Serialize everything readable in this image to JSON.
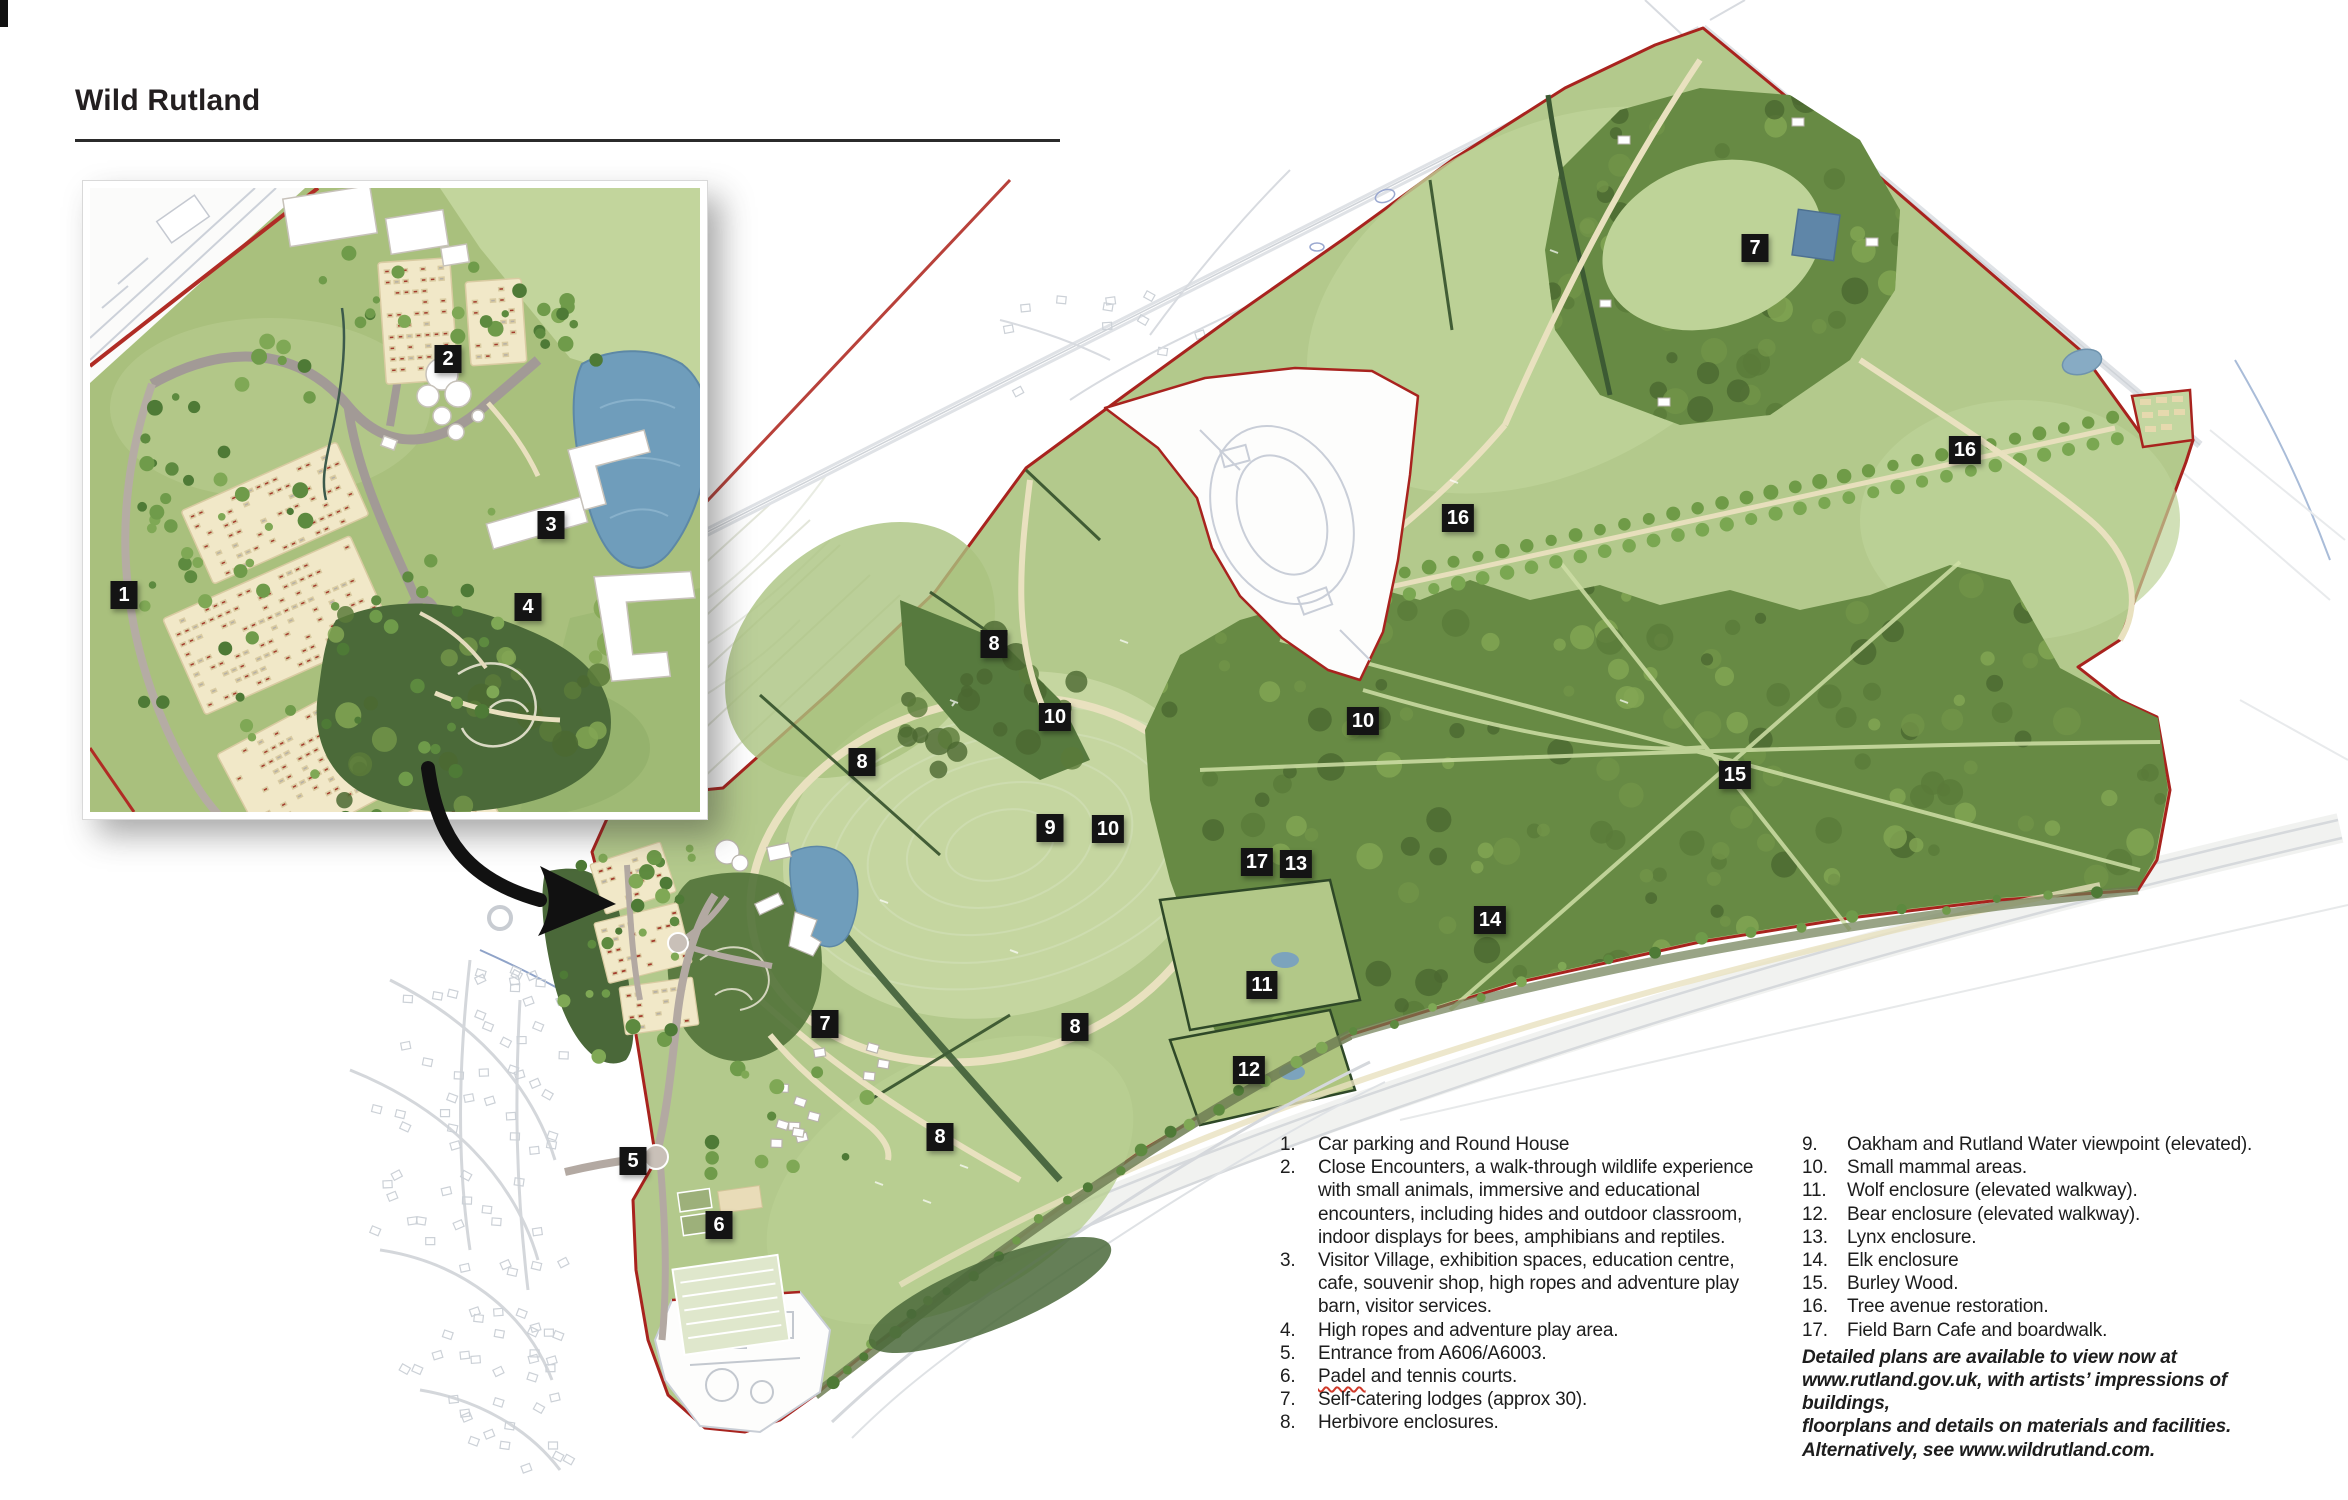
{
  "title": "Wild Rutland",
  "legend": {
    "col1": [
      {
        "n": "1.",
        "text": "Car parking and Round House"
      },
      {
        "n": "2.",
        "text": "Close Encounters, a walk-through wildlife experience with small animals, immersive and educational encounters, including hides and outdoor classroom, indoor displays for bees, amphibians and reptiles."
      },
      {
        "n": "3.",
        "text": "Visitor Village, exhibition spaces, education centre, cafe, souvenir shop, high ropes and adventure play barn, visitor services."
      },
      {
        "n": "4.",
        "text": "High ropes and adventure play area."
      },
      {
        "n": "5.",
        "text": "Entrance from A606/A6003."
      },
      {
        "n": "6.",
        "text": "Padel and tennis courts.",
        "squiggle_word": "Padel"
      },
      {
        "n": "7.",
        "text": "Self-catering lodges (approx 30)."
      },
      {
        "n": "8.",
        "text": "Herbivore enclosures."
      }
    ],
    "col2": [
      {
        "n": "9.",
        "text": "Oakham and Rutland Water viewpoint (elevated)."
      },
      {
        "n": "10.",
        "text": "Small mammal areas."
      },
      {
        "n": "11.",
        "text": "Wolf enclosure (elevated walkway)."
      },
      {
        "n": "12.",
        "text": "Bear enclosure (elevated walkway)."
      },
      {
        "n": "13.",
        "text": "Lynx enclosure."
      },
      {
        "n": "14.",
        "text": "Elk enclosure"
      },
      {
        "n": "15.",
        "text": "Burley Wood."
      },
      {
        "n": "16.",
        "text": "Tree avenue restoration."
      },
      {
        "n": "17.",
        "text": "Field Barn Cafe and boardwalk."
      }
    ],
    "note_lines": [
      "Detailed plans are available to view now at",
      "www.rutland.gov.uk, with artists’ impressions of buildings,",
      "floorplans and details on materials and facilities.",
      "Alternatively, see www.wildrutland.com."
    ]
  },
  "markers": {
    "inset": [
      {
        "n": "1",
        "x": 124,
        "y": 595
      },
      {
        "n": "2",
        "x": 448,
        "y": 359
      },
      {
        "n": "3",
        "x": 551,
        "y": 525
      },
      {
        "n": "4",
        "x": 528,
        "y": 607
      }
    ],
    "main": [
      {
        "n": "7",
        "x": 1755,
        "y": 248
      },
      {
        "n": "16",
        "x": 1965,
        "y": 450
      },
      {
        "n": "16",
        "x": 1458,
        "y": 518
      },
      {
        "n": "8",
        "x": 994,
        "y": 644
      },
      {
        "n": "10",
        "x": 1055,
        "y": 717
      },
      {
        "n": "10",
        "x": 1363,
        "y": 721
      },
      {
        "n": "8",
        "x": 862,
        "y": 762
      },
      {
        "n": "15",
        "x": 1735,
        "y": 775
      },
      {
        "n": "9",
        "x": 1050,
        "y": 828
      },
      {
        "n": "10",
        "x": 1108,
        "y": 829
      },
      {
        "n": "17",
        "x": 1257,
        "y": 862
      },
      {
        "n": "13",
        "x": 1296,
        "y": 864
      },
      {
        "n": "14",
        "x": 1490,
        "y": 920
      },
      {
        "n": "11",
        "x": 1262,
        "y": 985
      },
      {
        "n": "7",
        "x": 825,
        "y": 1024
      },
      {
        "n": "8",
        "x": 1075,
        "y": 1027
      },
      {
        "n": "12",
        "x": 1249,
        "y": 1070
      },
      {
        "n": "8",
        "x": 940,
        "y": 1137
      },
      {
        "n": "5",
        "x": 633,
        "y": 1161
      },
      {
        "n": "6",
        "x": 719,
        "y": 1225
      }
    ]
  },
  "colors": {
    "boundary_red": "#a8231e",
    "field_green": "#b3c98c",
    "woodland_green": "#678a44",
    "dark_wood_green": "#4b6a39",
    "path_cream": "#ece4c2",
    "water_blue": "#6f9dbb",
    "parking_beige": "#f1e8c8",
    "marker_bg": "#141414",
    "marker_text": "#ffffff",
    "title_color": "#231f20"
  }
}
